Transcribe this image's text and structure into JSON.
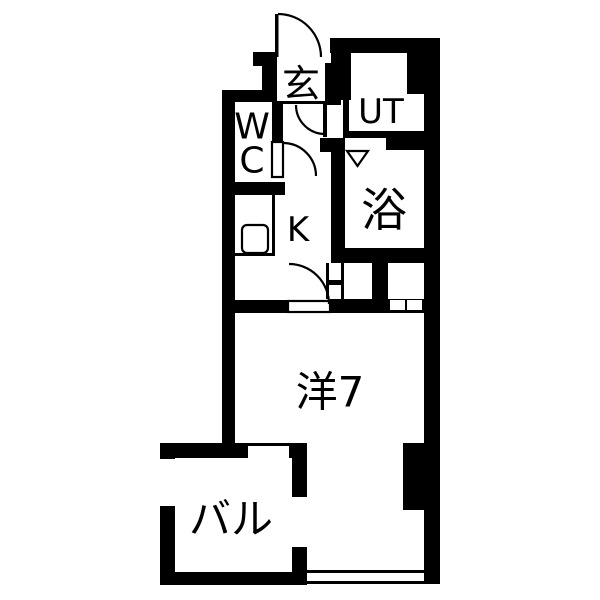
{
  "plan": {
    "colors": {
      "background": "#ffffff",
      "walls": "#000000",
      "labels": "#000000"
    },
    "rooms": [
      {
        "id": "genkan",
        "label": "玄"
      },
      {
        "id": "utility",
        "label": "UT"
      },
      {
        "id": "toilet",
        "label_line1": "W",
        "label_line2": "C"
      },
      {
        "id": "bath",
        "label": "浴"
      },
      {
        "id": "kitchen",
        "label": "K"
      },
      {
        "id": "main-room",
        "label": "洋7"
      },
      {
        "id": "balcony",
        "label": "バル"
      }
    ]
  }
}
